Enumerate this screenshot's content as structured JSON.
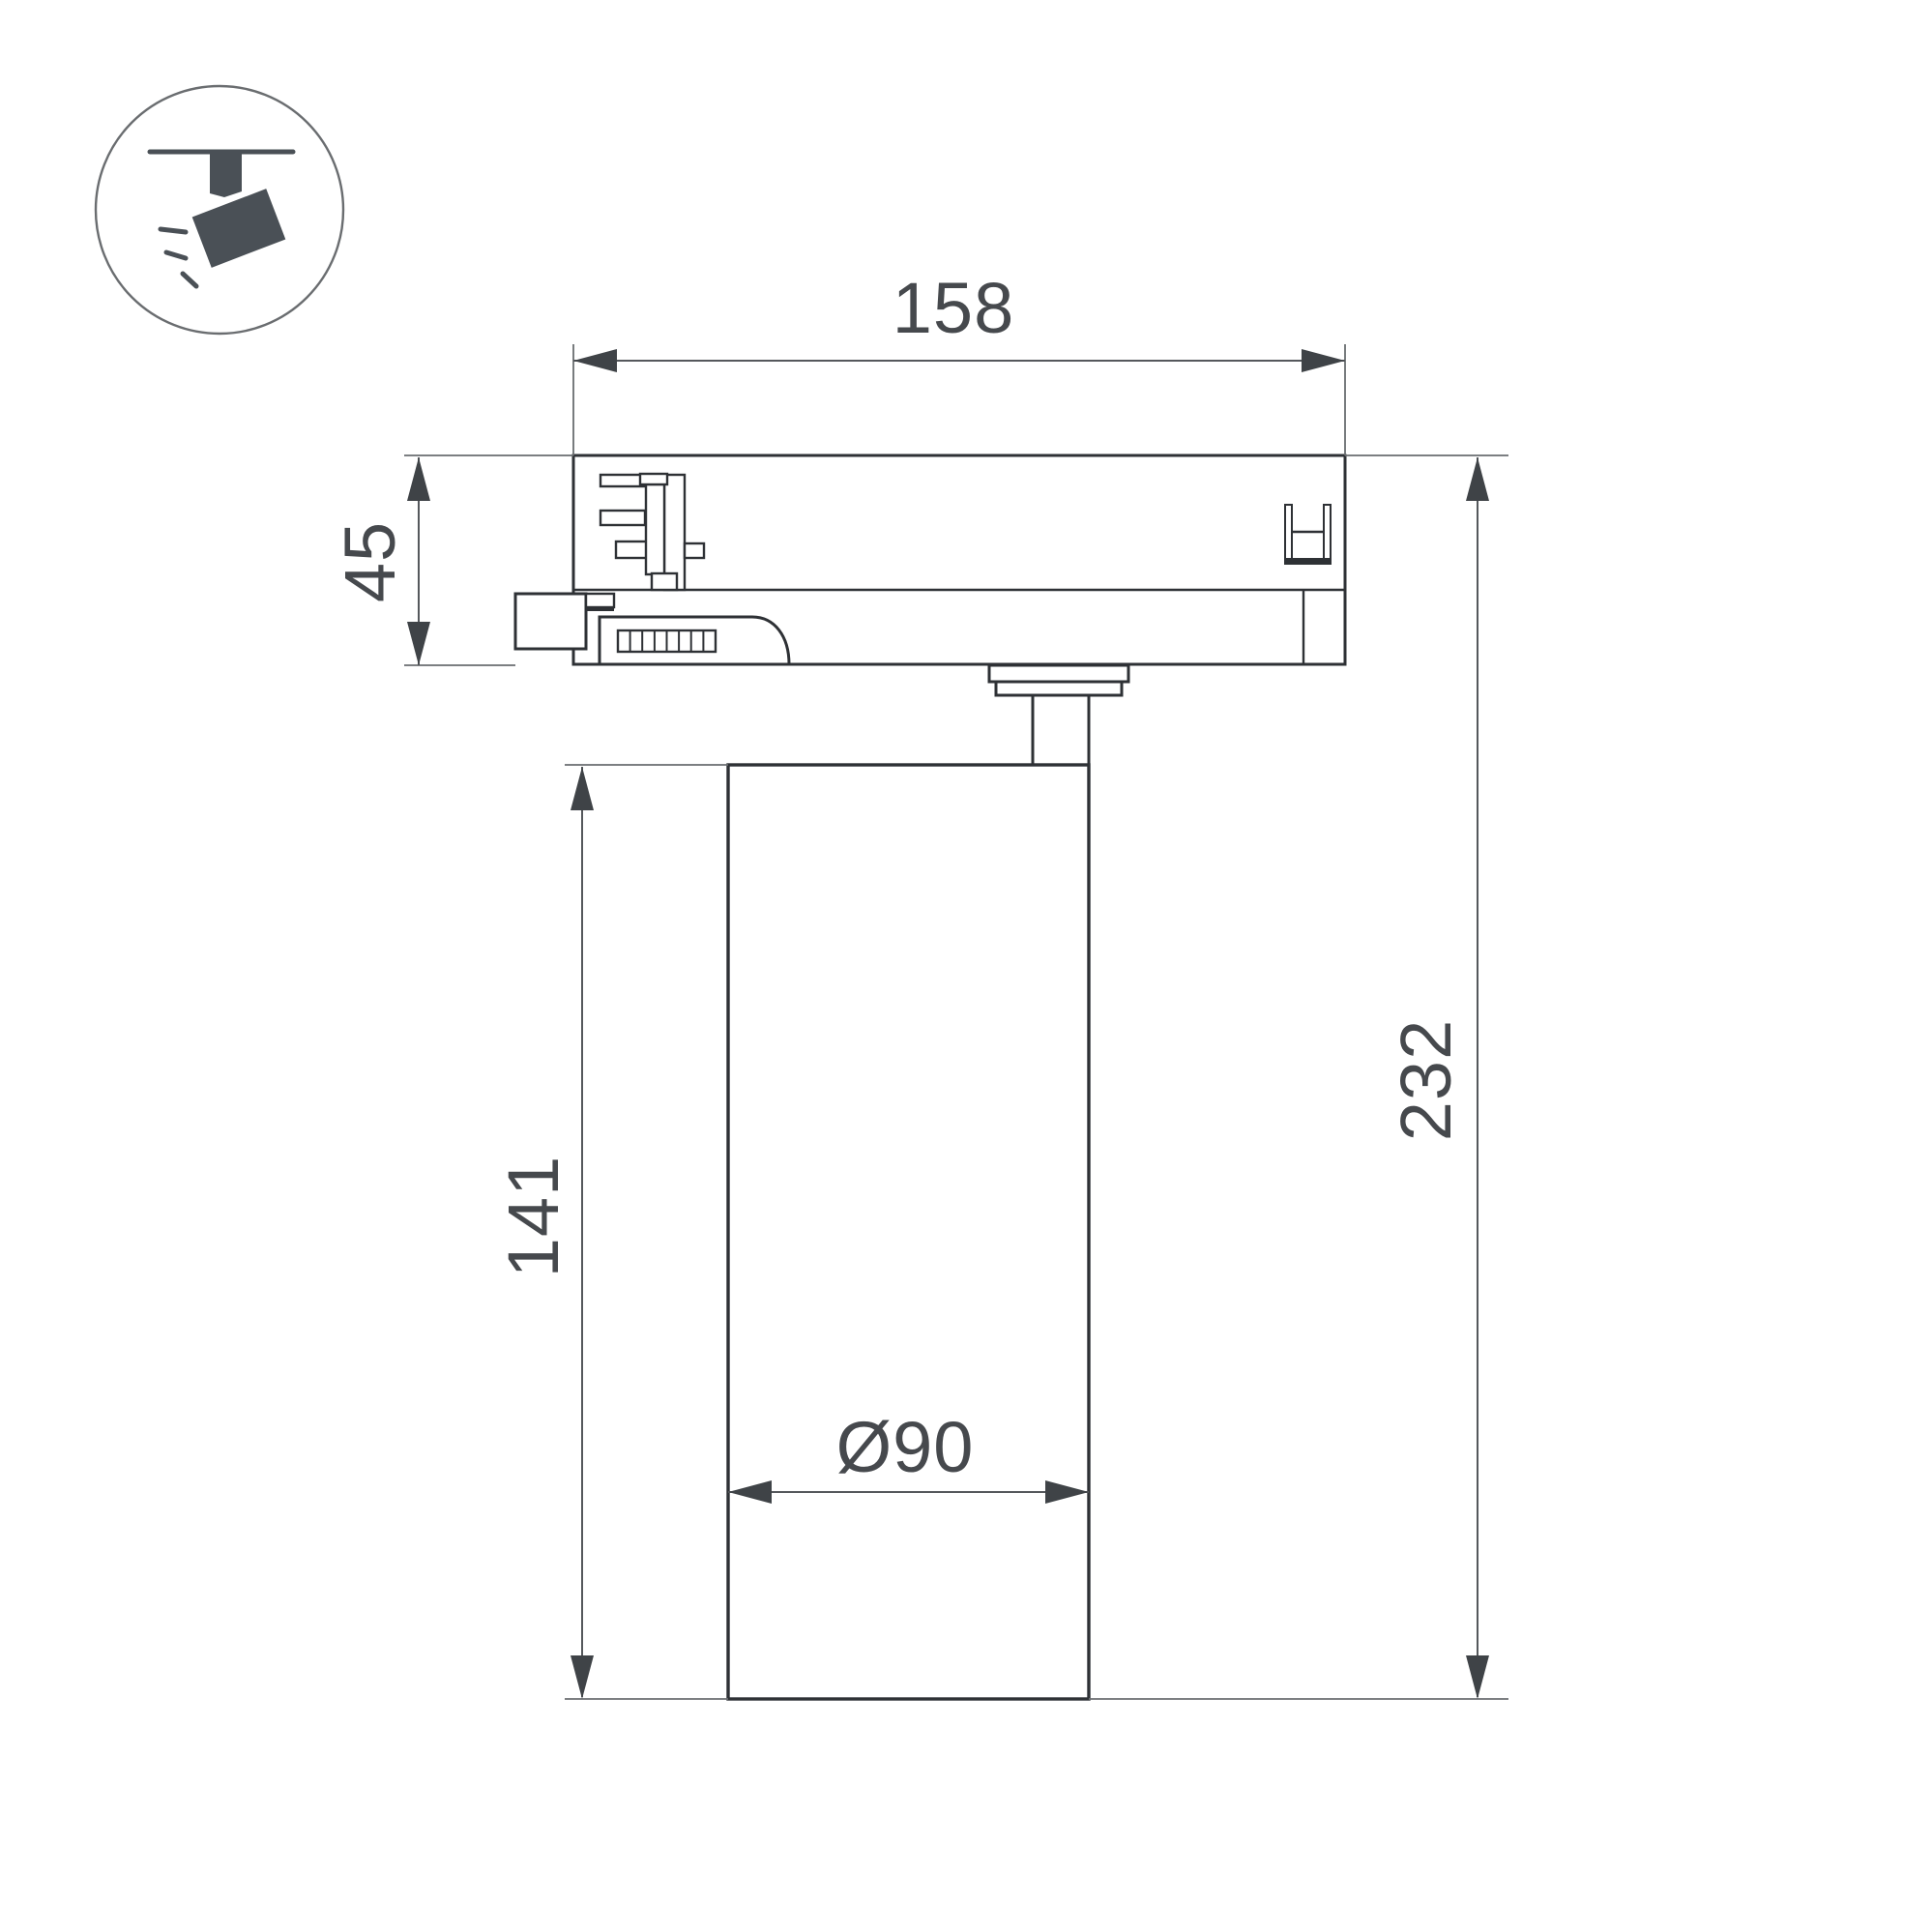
{
  "meta": {
    "title": "Track spotlight dimensional drawing",
    "view": "side section view",
    "units": "mm"
  },
  "dims": {
    "adapter_width": "158",
    "adapter_height": "45",
    "body_height": "141",
    "total_height": "232",
    "body_diameter": "Ø90"
  },
  "icon": {
    "name": "track-spotlight-icon",
    "parts": [
      "ceiling-line",
      "track-stub",
      "lamp-head",
      "light-rays"
    ]
  },
  "colors": {
    "background": "#ffffff",
    "outline": "#2e3135",
    "dimension_lines": "#55585c",
    "dimension_text": "#46494d",
    "icon": "#4a5056"
  }
}
